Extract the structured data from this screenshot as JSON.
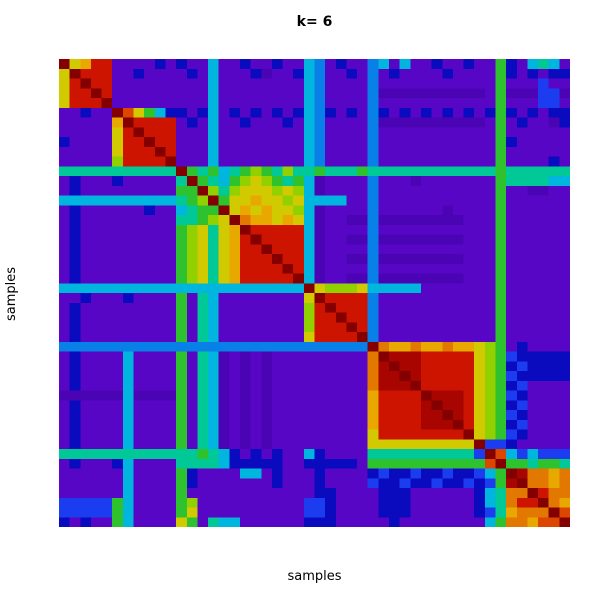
{
  "title": "k= 6",
  "axes": {
    "x_label": "samples",
    "y_label": "samples"
  },
  "colors": {
    "page_background": "#ffffff",
    "text": "#000000"
  },
  "chart_data": {
    "type": "heatmap",
    "title": "k= 6",
    "xlabel": "samples",
    "ylabel": "samples",
    "k": 6,
    "legend": "none",
    "axis_ticks": "none",
    "value_scale": "consensus 0 (blue/purple) to 1 (dark red); rainbow colormap",
    "grid": {
      "rows": 48,
      "cols": 48
    },
    "clusters": [
      {
        "id": 1,
        "range": [
          0,
          4
        ]
      },
      {
        "id": 2,
        "range": [
          5,
          10
        ]
      },
      {
        "id": 3,
        "range": [
          11,
          22
        ]
      },
      {
        "id": 4,
        "range": [
          23,
          28
        ]
      },
      {
        "id": 5,
        "range": [
          29,
          39
        ]
      },
      {
        "id": 6,
        "range": [
          40,
          47
        ]
      }
    ],
    "palette": {
      "0": "#5806C6",
      "1": "#4A04B4",
      "2": "#0A0ABE",
      "3": "#1C3CF0",
      "4": "#0880E8",
      "5": "#00B6DE",
      "6": "#00C896",
      "7": "#2EC22E",
      "8": "#92D100",
      "9": "#D2CA00",
      "a": "#E8A800",
      "b": "#E27800",
      "c": "#DC4600",
      "d": "#CC1400",
      "e": "#A80400",
      "f": "#840000"
    },
    "matrix_rows": [
      "f9add0000202005002002005402004505002002007205650",
      "9fddd0020000205000210025400204020000200007202022",
      "9dfdd0000000005000000005400004000000000007000300",
      "9ddfd0000000005000000005400004111111111107111331",
      "9dddf0000000005000000005400004000000000007000330",
      "00200fc97522025020202025420204202020202027202022",
      "00000afdddd0205002000205400004111111111107020012",
      "000009dfddd0005000000005400004000000000007000000",
      "200009ddfdd0005000000005400004000000000007200000",
      "000009dddfd0005000000005400004000000000007000000",
      "000008ddddf0005000000005400004000000000007000020",
      "66666666666f767567876866766676666666666667666666",
      "020002000006f76578987675100004000100000007666655",
      "0200000000077f8689998985100004000000000007001100",
      "55555555555678f799a99895555004000000000007000000",
      "020000002005677f9a9a9985100004000000100007000000",
      "0200000000066789fbaa9a95100114111111110007000000",
      "0200000000078969afddddd5100004000000000007000000",
      "0200000000078969adfdddd5100114111111110007000000",
      "0200000000078969addfddd5100004000000000007000000",
      "0200000000078969adddfdd5100114111111110007000000",
      "0200000000078969addddfd5100004000000000007000000",
      "0200000000078969adddddf5100114111111110007000000",
      "55555555555555555555555f988895555500000007000000",
      "002000200007065000000009fdddd4000000000007000000",
      "020000000007065000000008dfddd4000000000007000000",
      "020000000007065000000008ddfdd4000000000007000000",
      "020000000007065000000008dddfd4000000000007000000",
      "020000000007065000000009ddddf4000000000007000000",
      "44444444444444444444444444444fbaabaabaa987020000",
      "02000050000706510101000000000bfeeeddddd987322222",
      "02000050000706510101000000000befeeddddd987232222",
      "02000050000706510101000000000beefeddddd987322222",
      "02000050000706510101000000000beeefddddd987230000",
      "11111151111706510101000000000addddfeeed987320000",
      "02000050000706510101000000000addddefeed987230000",
      "02000050000706510101000000000addddeefed987320000",
      "02000050000706510101000000000addddeeefd987230000",
      "020000500007065101010000000009ddddddddf987320000",
      "020000500007065101010000000009999999999f33200000",
      "6666666666666765202020052000066666666663fc535333",
      "0200025000066665222220022222077777777777cf776776",
      "000000500007200005502000200002322322322357febbab",
      "000000500007200000002000200003223223223237efbbab",
      "000000500007000000000000220000222000000256bbfdbb",
      "333337500007800000000003320000222000000256bddfba",
      "333337500007900000000003320000222000000236abbbfc",
      "202007500009706550000002220000020000000057bbaccf"
    ]
  }
}
